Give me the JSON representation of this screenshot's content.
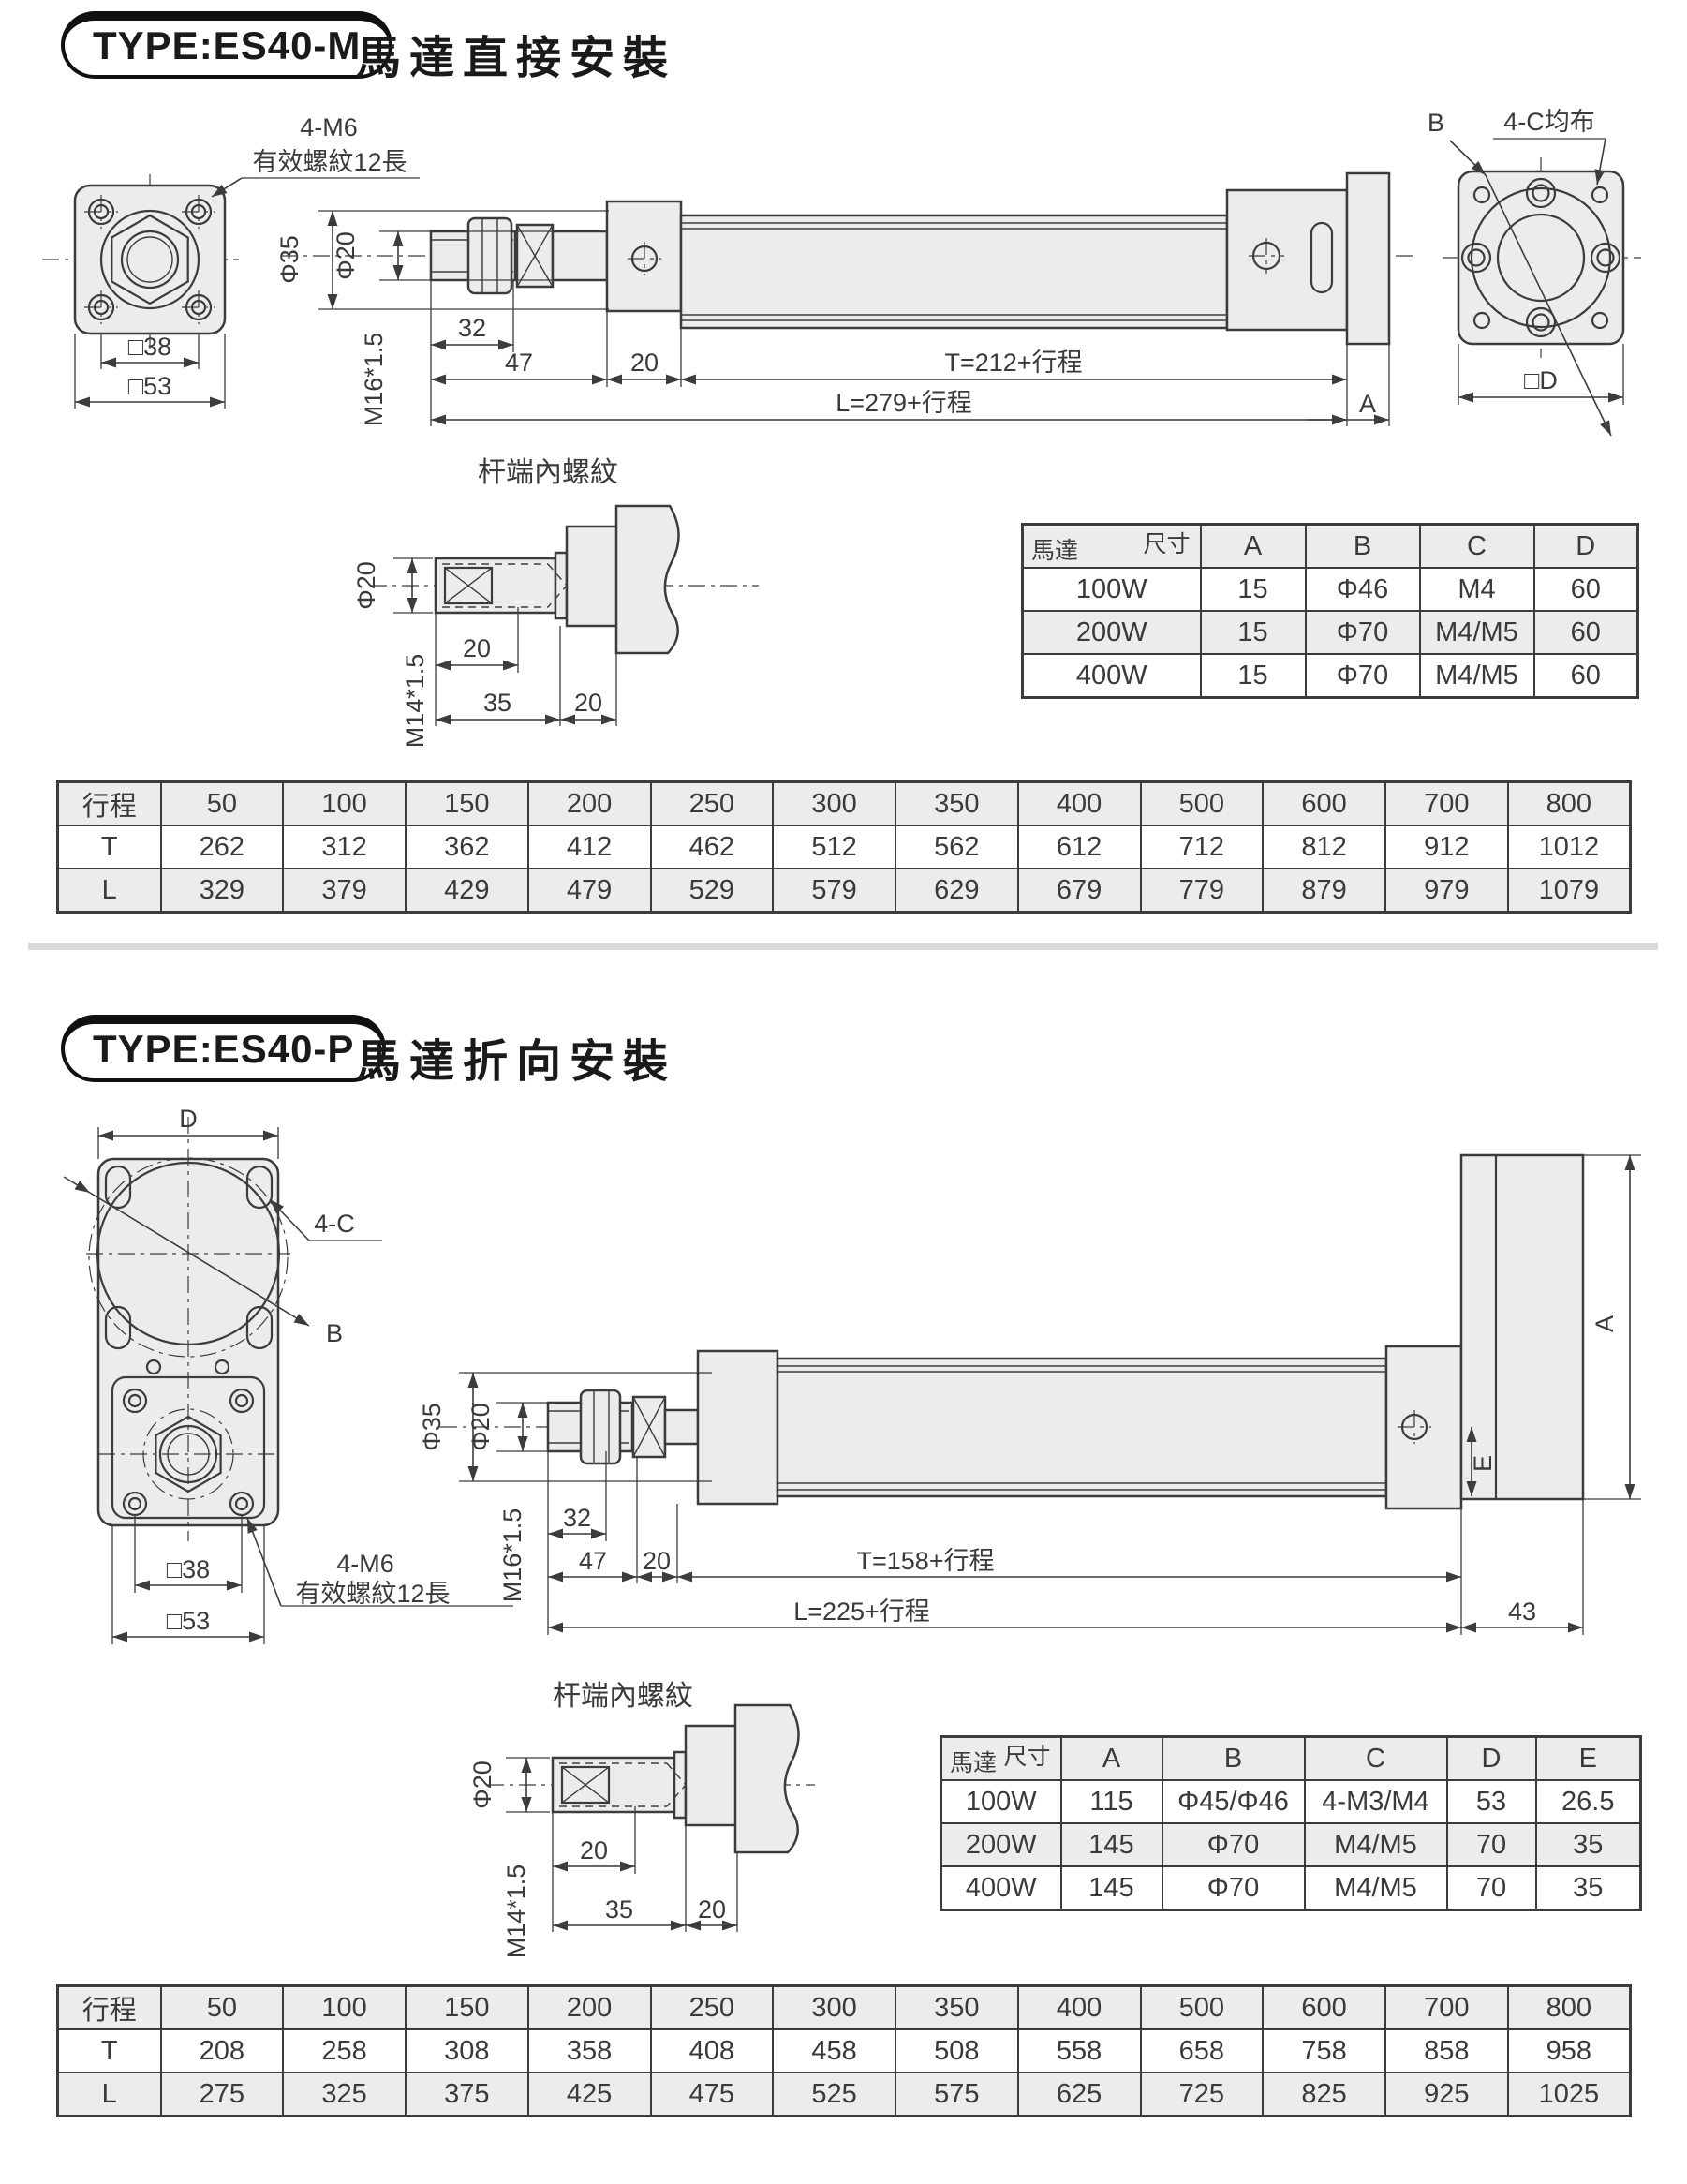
{
  "section1": {
    "badge": "TYPE:ES40-M",
    "title": "馬達直接安裝",
    "flange": {
      "note1": "4-M6",
      "note2": "有效螺紋12長",
      "sq38": "□38",
      "sq53": "□53"
    },
    "side": {
      "dia35": "Φ35",
      "dia20": "Φ20",
      "d32": "32",
      "d47": "47",
      "d20": "20",
      "m16": "M16*1.5",
      "T": "T=212+行程",
      "L": "L=279+行程",
      "A": "A"
    },
    "endview": {
      "B": "B",
      "note": "4-C均布",
      "sqD": "□D"
    },
    "rodend": {
      "title": "杆端內螺紋",
      "dia20": "Φ20",
      "d20a": "20",
      "m14": "M14*1.5",
      "d35": "35",
      "d20b": "20"
    },
    "motor_table": {
      "rows": [
        [
          {
            "top": "尺寸",
            "bottom": "馬達"
          },
          "A",
          "B",
          "C",
          "D"
        ],
        [
          "100W",
          "15",
          "Φ46",
          "M4",
          "60"
        ],
        [
          "200W",
          "15",
          "Φ70",
          "M4/M5",
          "60"
        ],
        [
          "400W",
          "15",
          "Φ70",
          "M4/M5",
          "60"
        ]
      ]
    },
    "stroke_table": {
      "rows": [
        [
          "行程",
          "50",
          "100",
          "150",
          "200",
          "250",
          "300",
          "350",
          "400",
          "500",
          "600",
          "700",
          "800"
        ],
        [
          "T",
          "262",
          "312",
          "362",
          "412",
          "462",
          "512",
          "562",
          "612",
          "712",
          "812",
          "912",
          "1012"
        ],
        [
          "L",
          "329",
          "379",
          "429",
          "479",
          "529",
          "579",
          "629",
          "679",
          "779",
          "879",
          "979",
          "1079"
        ]
      ]
    }
  },
  "section2": {
    "badge": "TYPE:ES40-P",
    "title": "馬達折向安裝",
    "flange": {
      "D": "D",
      "c4": "4-C",
      "B": "B",
      "sq38": "□38",
      "sq53": "□53",
      "note1": "4-M6",
      "note2": "有效螺紋12長"
    },
    "side": {
      "dia35": "Φ35",
      "dia20": "Φ20",
      "d32": "32",
      "d47": "47",
      "d20": "20",
      "m16": "M16*1.5",
      "T": "T=158+行程",
      "L": "L=225+行程",
      "d43": "43",
      "E": "E",
      "A": "A"
    },
    "rodend": {
      "title": "杆端內螺紋",
      "dia20": "Φ20",
      "d20a": "20",
      "m14": "M14*1.5",
      "d35": "35",
      "d20b": "20"
    },
    "motor_table": {
      "rows": [
        [
          {
            "top": "尺寸",
            "bottom": "馬達"
          },
          "A",
          "B",
          "C",
          "D",
          "E"
        ],
        [
          "100W",
          "115",
          "Φ45/Φ46",
          "4-M3/M4",
          "53",
          "26.5"
        ],
        [
          "200W",
          "145",
          "Φ70",
          "M4/M5",
          "70",
          "35"
        ],
        [
          "400W",
          "145",
          "Φ70",
          "M4/M5",
          "70",
          "35"
        ]
      ]
    },
    "stroke_table": {
      "rows": [
        [
          "行程",
          "50",
          "100",
          "150",
          "200",
          "250",
          "300",
          "350",
          "400",
          "500",
          "600",
          "700",
          "800"
        ],
        [
          "T",
          "208",
          "258",
          "308",
          "358",
          "408",
          "458",
          "508",
          "558",
          "658",
          "758",
          "858",
          "958"
        ],
        [
          "L",
          "275",
          "325",
          "375",
          "425",
          "475",
          "525",
          "575",
          "625",
          "725",
          "825",
          "925",
          "1025"
        ]
      ]
    }
  }
}
